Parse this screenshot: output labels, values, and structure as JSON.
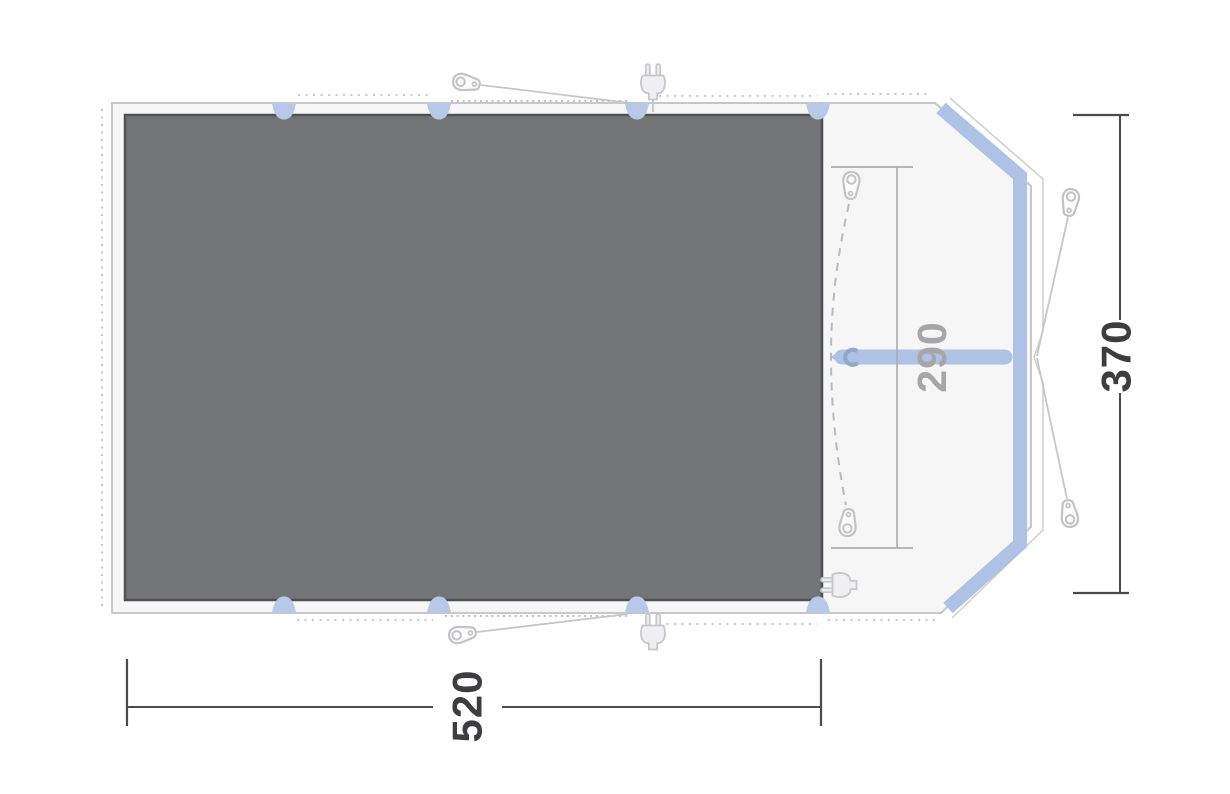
{
  "diagram": {
    "type": "tent-floorplan-top-view",
    "dimensions": {
      "total_width_label": "520",
      "total_depth_label": "370",
      "inner_width_label": "290"
    },
    "colors": {
      "groundsheet": "#737476",
      "groundsheet_border": "#515153",
      "tent_fill": "#f6f6f7",
      "tent_outline": "#c7c8ca",
      "pole_blue": "#adc2e4",
      "tab_blue": "#b7c9e8",
      "hook_blue": "#93a7c9",
      "dim_dark": "#3d3d3f",
      "dim_gray": "#a6a6a8",
      "peg_stroke": "#c2c3c5",
      "dotted_gray": "#c9cacc"
    },
    "icons": {
      "guyline_peg": "guyline-peg-icon",
      "inner_peg": "inner-peg-icon",
      "power_plug": "power-plug-icon",
      "pole_roll_hook": "pole-roll-hook-icon"
    }
  }
}
